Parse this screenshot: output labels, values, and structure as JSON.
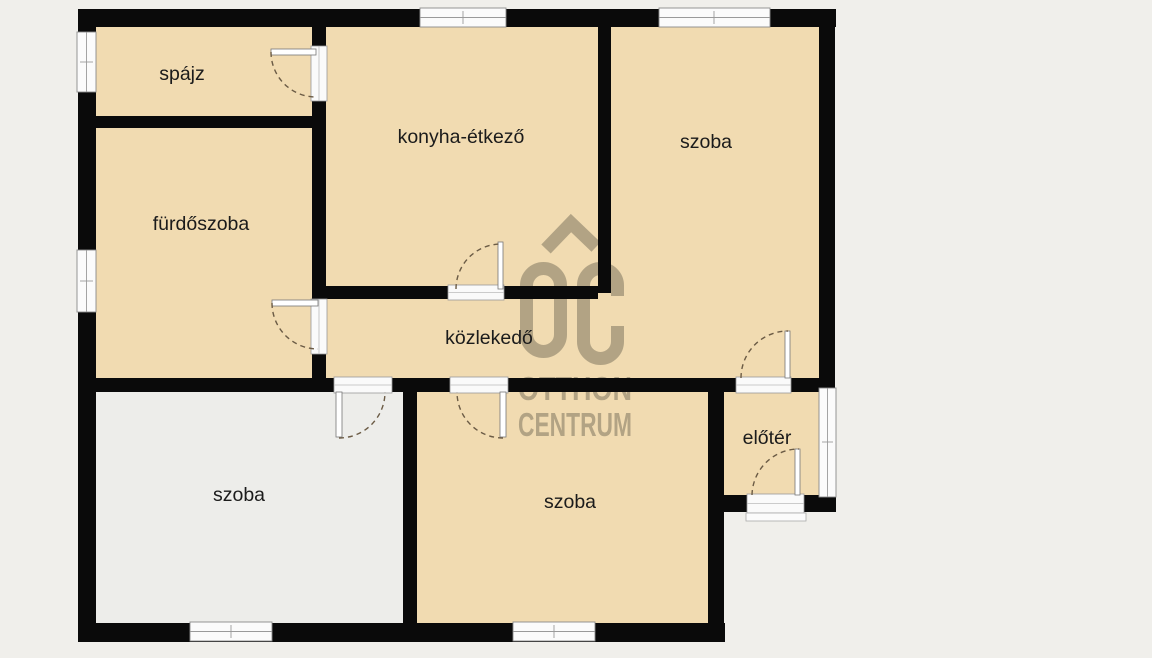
{
  "plan": {
    "type": "apartment-floor-plan",
    "rooms": [
      {
        "id": "spajz",
        "label": "spájz"
      },
      {
        "id": "konyha-etkezo",
        "label": "konyha-étkező"
      },
      {
        "id": "szoba-felso",
        "label": "szoba"
      },
      {
        "id": "furdoszoba",
        "label": "fürdőszoba"
      },
      {
        "id": "kozlekedo",
        "label": "közlekedő"
      },
      {
        "id": "szoba-bal-also",
        "label": "szoba"
      },
      {
        "id": "szoba-kozep-also",
        "label": "szoba"
      },
      {
        "id": "eloter",
        "label": "előtér"
      }
    ]
  },
  "watermark": {
    "monogram": "OC",
    "line1": "OTTHON",
    "line2": "CENTRUM"
  },
  "colors": {
    "background": "#f0efeb",
    "floor_tan": "#f1dbb1",
    "floor_light": "#ededea",
    "wall": "#0a0a0a",
    "window_fill": "#fbfbfb",
    "frame_stroke": "#8a8a8a",
    "door_arc": "#6b5b45",
    "watermark": "#6e6754",
    "label": "#1b1b1b"
  }
}
